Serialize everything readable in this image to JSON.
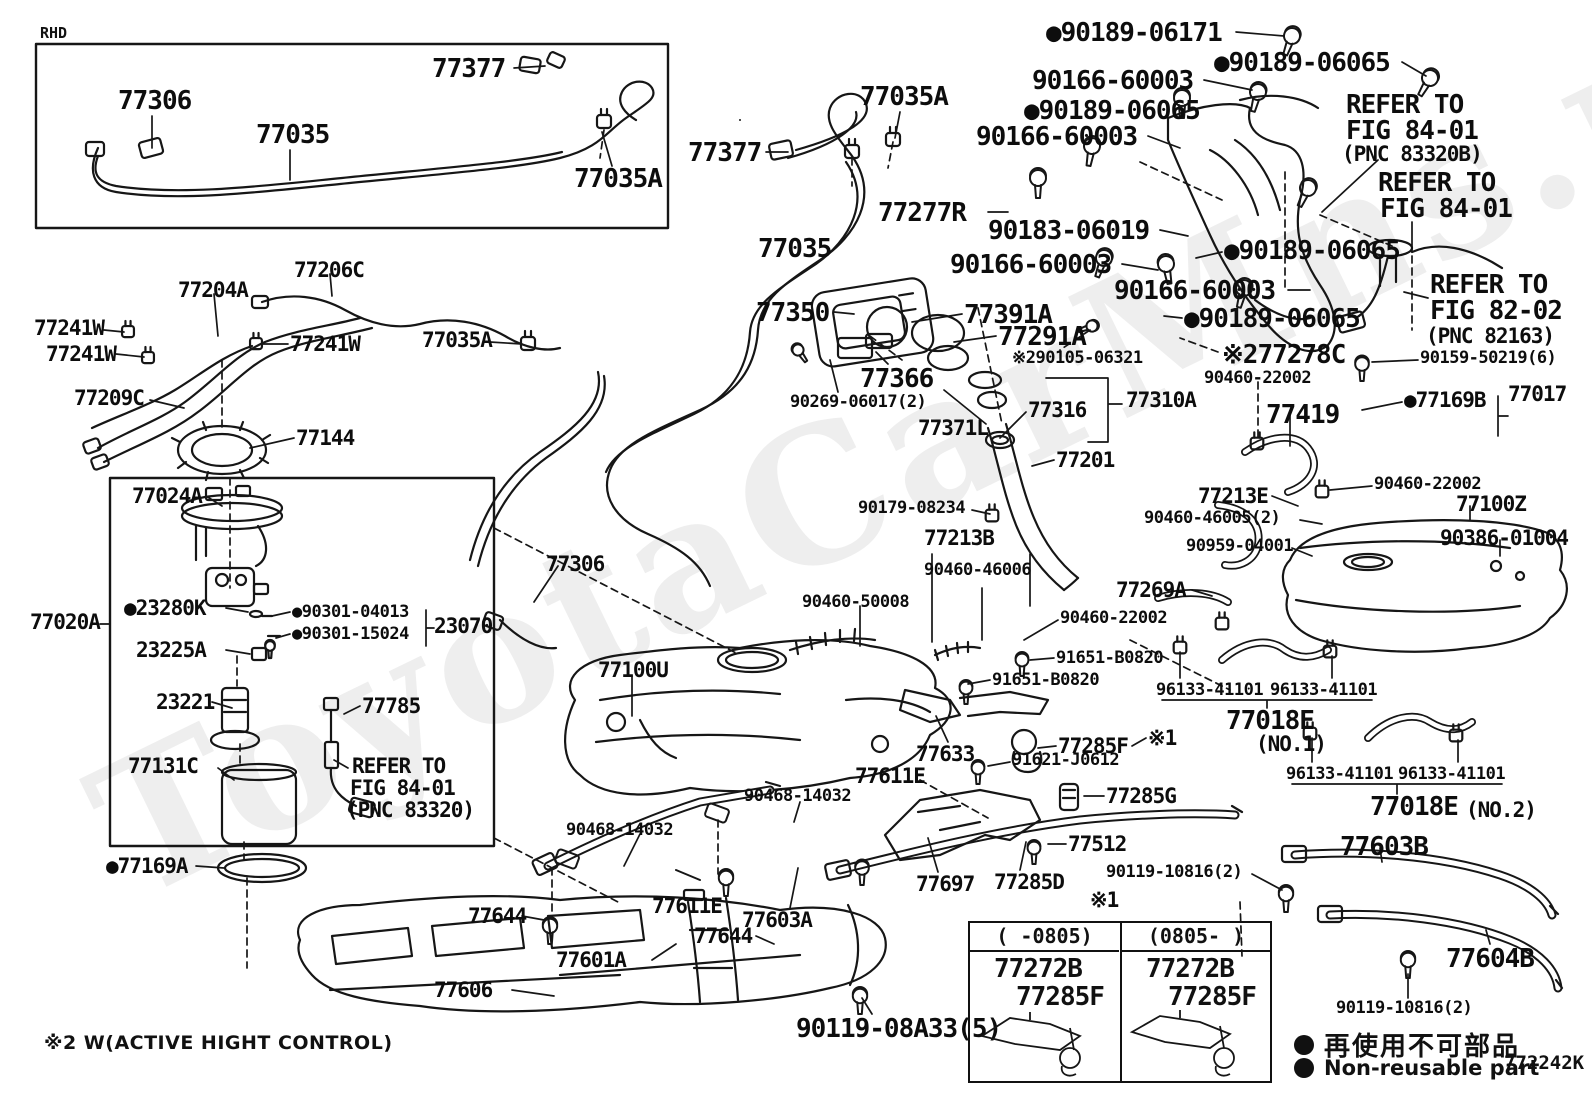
{
  "watermark": "ToyotaCarMns.ru",
  "diagram_code": "772242K",
  "rhd_tag": "RHD",
  "footnotes": {
    "bottom_left": "※2 W(ACTIVE HIGHT CONTROL)"
  },
  "legend": {
    "jp": "再使用不可部品",
    "en": "Non-reusable part"
  },
  "table": {
    "headers": [
      "(  -0805)",
      "(0805-   )"
    ],
    "columns": [
      {
        "part": "77272B",
        "sub": "77285F"
      },
      {
        "part": "77272B",
        "sub": "77285F"
      }
    ]
  },
  "labels": [
    {
      "t": "77377",
      "x": 432,
      "y": 56,
      "c": "lg"
    },
    {
      "t": "77306",
      "x": 118,
      "y": 88,
      "c": "lg"
    },
    {
      "t": "77035",
      "x": 256,
      "y": 122,
      "c": "lg"
    },
    {
      "t": "77035A",
      "x": 574,
      "y": 166,
      "c": "lg"
    },
    {
      "t": "●90189-06171",
      "x": 1046,
      "y": 20,
      "c": "lg"
    },
    {
      "t": "●90189-06065",
      "x": 1214,
      "y": 50,
      "c": "lg"
    },
    {
      "t": "90166-60003",
      "x": 1032,
      "y": 68,
      "c": "lg"
    },
    {
      "t": "●90189-06065",
      "x": 1024,
      "y": 98,
      "c": "lg"
    },
    {
      "t": "90166-60003",
      "x": 976,
      "y": 124,
      "c": "lg"
    },
    {
      "t": "REFER TO",
      "x": 1346,
      "y": 92,
      "c": "lg"
    },
    {
      "t": "FIG 84-01",
      "x": 1346,
      "y": 118,
      "c": "lg"
    },
    {
      "t": "(PNC 83320B)",
      "x": 1342,
      "y": 144,
      "c": "md"
    },
    {
      "t": "REFER TO",
      "x": 1378,
      "y": 170,
      "c": "lg"
    },
    {
      "t": "FIG 84-01",
      "x": 1380,
      "y": 196,
      "c": "lg"
    },
    {
      "t": "77377",
      "x": 688,
      "y": 140,
      "c": "lg"
    },
    {
      "t": "77035A",
      "x": 860,
      "y": 84,
      "c": "lg"
    },
    {
      "t": "77277R",
      "x": 878,
      "y": 200,
      "c": "lg"
    },
    {
      "t": "90183-06019",
      "x": 988,
      "y": 218,
      "c": "lg"
    },
    {
      "t": "77035",
      "x": 758,
      "y": 236,
      "c": "lg"
    },
    {
      "t": "90166-60003",
      "x": 950,
      "y": 252,
      "c": "lg"
    },
    {
      "t": "●90189-06065",
      "x": 1224,
      "y": 238,
      "c": "lg"
    },
    {
      "t": "90166-60003",
      "x": 1114,
      "y": 278,
      "c": "lg"
    },
    {
      "t": "●90189-06065",
      "x": 1184,
      "y": 306,
      "c": "lg"
    },
    {
      "t": "REFER TO",
      "x": 1430,
      "y": 272,
      "c": "lg"
    },
    {
      "t": "FIG 82-02",
      "x": 1430,
      "y": 298,
      "c": "lg"
    },
    {
      "t": "(PNC 82163)",
      "x": 1426,
      "y": 326,
      "c": "md"
    },
    {
      "t": "77350",
      "x": 756,
      "y": 300,
      "c": "lg"
    },
    {
      "t": "77391A",
      "x": 964,
      "y": 302,
      "c": "lg"
    },
    {
      "t": "77291A",
      "x": 998,
      "y": 324,
      "c": "lg"
    },
    {
      "t": "※290105-06321",
      "x": 1012,
      "y": 350,
      "c": "sm"
    },
    {
      "t": "※277278C",
      "x": 1222,
      "y": 342,
      "c": "lg"
    },
    {
      "t": "77366",
      "x": 860,
      "y": 366,
      "c": "lg"
    },
    {
      "t": "90269-06017(2)",
      "x": 790,
      "y": 394,
      "c": "sm"
    },
    {
      "t": "90159-50219(6)",
      "x": 1420,
      "y": 350,
      "c": "sm"
    },
    {
      "t": "90460-22002",
      "x": 1204,
      "y": 370,
      "c": "sm"
    },
    {
      "t": "●77169B",
      "x": 1404,
      "y": 390,
      "c": "md"
    },
    {
      "t": "77017",
      "x": 1508,
      "y": 384,
      "c": "md"
    },
    {
      "t": "77419",
      "x": 1266,
      "y": 402,
      "c": "lg"
    },
    {
      "t": "77316",
      "x": 1028,
      "y": 400,
      "c": "md"
    },
    {
      "t": "77310A",
      "x": 1126,
      "y": 390,
      "c": "md"
    },
    {
      "t": "77371L",
      "x": 918,
      "y": 418,
      "c": "md"
    },
    {
      "t": "77201",
      "x": 1056,
      "y": 450,
      "c": "md"
    },
    {
      "t": "90460-22002",
      "x": 1374,
      "y": 476,
      "c": "sm"
    },
    {
      "t": "90179-08234",
      "x": 858,
      "y": 500,
      "c": "sm"
    },
    {
      "t": "77213B",
      "x": 924,
      "y": 528,
      "c": "md"
    },
    {
      "t": "90460-46006",
      "x": 924,
      "y": 562,
      "c": "sm"
    },
    {
      "t": "90460-50008",
      "x": 802,
      "y": 594,
      "c": "sm"
    },
    {
      "t": "77213E",
      "x": 1198,
      "y": 486,
      "c": "md"
    },
    {
      "t": "90460-46005(2)",
      "x": 1144,
      "y": 510,
      "c": "sm"
    },
    {
      "t": "90959-04001",
      "x": 1186,
      "y": 538,
      "c": "sm"
    },
    {
      "t": "77100Z",
      "x": 1456,
      "y": 494,
      "c": "md"
    },
    {
      "t": "90386-01004",
      "x": 1440,
      "y": 528,
      "c": "md"
    },
    {
      "t": "77269A",
      "x": 1116,
      "y": 580,
      "c": "md"
    },
    {
      "t": "90460-22002",
      "x": 1060,
      "y": 610,
      "c": "sm"
    },
    {
      "t": "91651-B0820",
      "x": 1056,
      "y": 650,
      "c": "sm"
    },
    {
      "t": "91651-B0820",
      "x": 992,
      "y": 672,
      "c": "sm"
    },
    {
      "t": "77100U",
      "x": 598,
      "y": 660,
      "c": "md"
    },
    {
      "t": "77204A",
      "x": 178,
      "y": 280,
      "c": "md"
    },
    {
      "t": "77206C",
      "x": 294,
      "y": 260,
      "c": "md"
    },
    {
      "t": "77241W",
      "x": 34,
      "y": 318,
      "c": "md"
    },
    {
      "t": "77241W",
      "x": 46,
      "y": 344,
      "c": "md"
    },
    {
      "t": "77241W",
      "x": 290,
      "y": 334,
      "c": "md"
    },
    {
      "t": "77035A",
      "x": 422,
      "y": 330,
      "c": "md"
    },
    {
      "t": "77209C",
      "x": 74,
      "y": 388,
      "c": "md"
    },
    {
      "t": "77144",
      "x": 296,
      "y": 428,
      "c": "md"
    },
    {
      "t": "77306",
      "x": 546,
      "y": 554,
      "c": "md"
    },
    {
      "t": "77024A",
      "x": 132,
      "y": 486,
      "c": "md"
    },
    {
      "t": "77020A",
      "x": 30,
      "y": 612,
      "c": "md"
    },
    {
      "t": "●23280K",
      "x": 124,
      "y": 598,
      "c": "md"
    },
    {
      "t": "●90301-04013",
      "x": 292,
      "y": 604,
      "c": "sm"
    },
    {
      "t": "●90301-15024",
      "x": 292,
      "y": 626,
      "c": "sm"
    },
    {
      "t": "23070",
      "x": 434,
      "y": 616,
      "c": "md"
    },
    {
      "t": "23225A",
      "x": 136,
      "y": 640,
      "c": "md"
    },
    {
      "t": "23221",
      "x": 156,
      "y": 692,
      "c": "md"
    },
    {
      "t": "77785",
      "x": 362,
      "y": 696,
      "c": "md"
    },
    {
      "t": "77131C",
      "x": 128,
      "y": 756,
      "c": "md"
    },
    {
      "t": "REFER TO",
      "x": 352,
      "y": 756,
      "c": "md"
    },
    {
      "t": "FIG 84-01",
      "x": 350,
      "y": 778,
      "c": "md"
    },
    {
      "t": "(PNC 83320)",
      "x": 346,
      "y": 800,
      "c": "md"
    },
    {
      "t": "●77169A",
      "x": 106,
      "y": 856,
      "c": "md"
    },
    {
      "t": "77633",
      "x": 916,
      "y": 744,
      "c": "md"
    },
    {
      "t": "77611E",
      "x": 855,
      "y": 766,
      "c": "md"
    },
    {
      "t": "91621-J0612",
      "x": 1012,
      "y": 752,
      "c": "sm"
    },
    {
      "t": "77285F",
      "x": 1058,
      "y": 736,
      "c": "md"
    },
    {
      "t": "※1",
      "x": 1148,
      "y": 728,
      "c": "md"
    },
    {
      "t": "77285G",
      "x": 1106,
      "y": 786,
      "c": "md"
    },
    {
      "t": "77512",
      "x": 1068,
      "y": 834,
      "c": "md"
    },
    {
      "t": "90468-14032",
      "x": 744,
      "y": 788,
      "c": "sm"
    },
    {
      "t": "90468-14032",
      "x": 566,
      "y": 822,
      "c": "sm"
    },
    {
      "t": "77644",
      "x": 468,
      "y": 906,
      "c": "md"
    },
    {
      "t": "77601A",
      "x": 556,
      "y": 950,
      "c": "md"
    },
    {
      "t": "77611E",
      "x": 652,
      "y": 896,
      "c": "md"
    },
    {
      "t": "77644",
      "x": 694,
      "y": 926,
      "c": "md"
    },
    {
      "t": "77603A",
      "x": 742,
      "y": 910,
      "c": "md"
    },
    {
      "t": "77606",
      "x": 434,
      "y": 980,
      "c": "md"
    },
    {
      "t": "77697",
      "x": 916,
      "y": 874,
      "c": "md"
    },
    {
      "t": "77285D",
      "x": 994,
      "y": 872,
      "c": "md"
    },
    {
      "t": "90119-08A33(5)",
      "x": 796,
      "y": 1016,
      "c": "lg"
    },
    {
      "t": "90119-10816(2)",
      "x": 1106,
      "y": 864,
      "c": "sm"
    },
    {
      "t": "96133-41101",
      "x": 1156,
      "y": 682,
      "c": "sm"
    },
    {
      "t": "96133-41101",
      "x": 1270,
      "y": 682,
      "c": "sm"
    },
    {
      "t": "77018E",
      "x": 1226,
      "y": 708,
      "c": "lg"
    },
    {
      "t": "(NO.1)",
      "x": 1256,
      "y": 734,
      "c": "md"
    },
    {
      "t": "96133-41101",
      "x": 1286,
      "y": 766,
      "c": "sm"
    },
    {
      "t": "96133-41101",
      "x": 1398,
      "y": 766,
      "c": "sm"
    },
    {
      "t": "77018E",
      "x": 1370,
      "y": 794,
      "c": "lg"
    },
    {
      "t": "(NO.2)",
      "x": 1466,
      "y": 800,
      "c": "md"
    },
    {
      "t": "77603B",
      "x": 1340,
      "y": 834,
      "c": "lg"
    },
    {
      "t": "77604B",
      "x": 1446,
      "y": 946,
      "c": "lg"
    },
    {
      "t": "90119-10816(2)",
      "x": 1336,
      "y": 1000,
      "c": "sm"
    },
    {
      "t": "※1",
      "x": 1090,
      "y": 890,
      "c": "md"
    }
  ]
}
